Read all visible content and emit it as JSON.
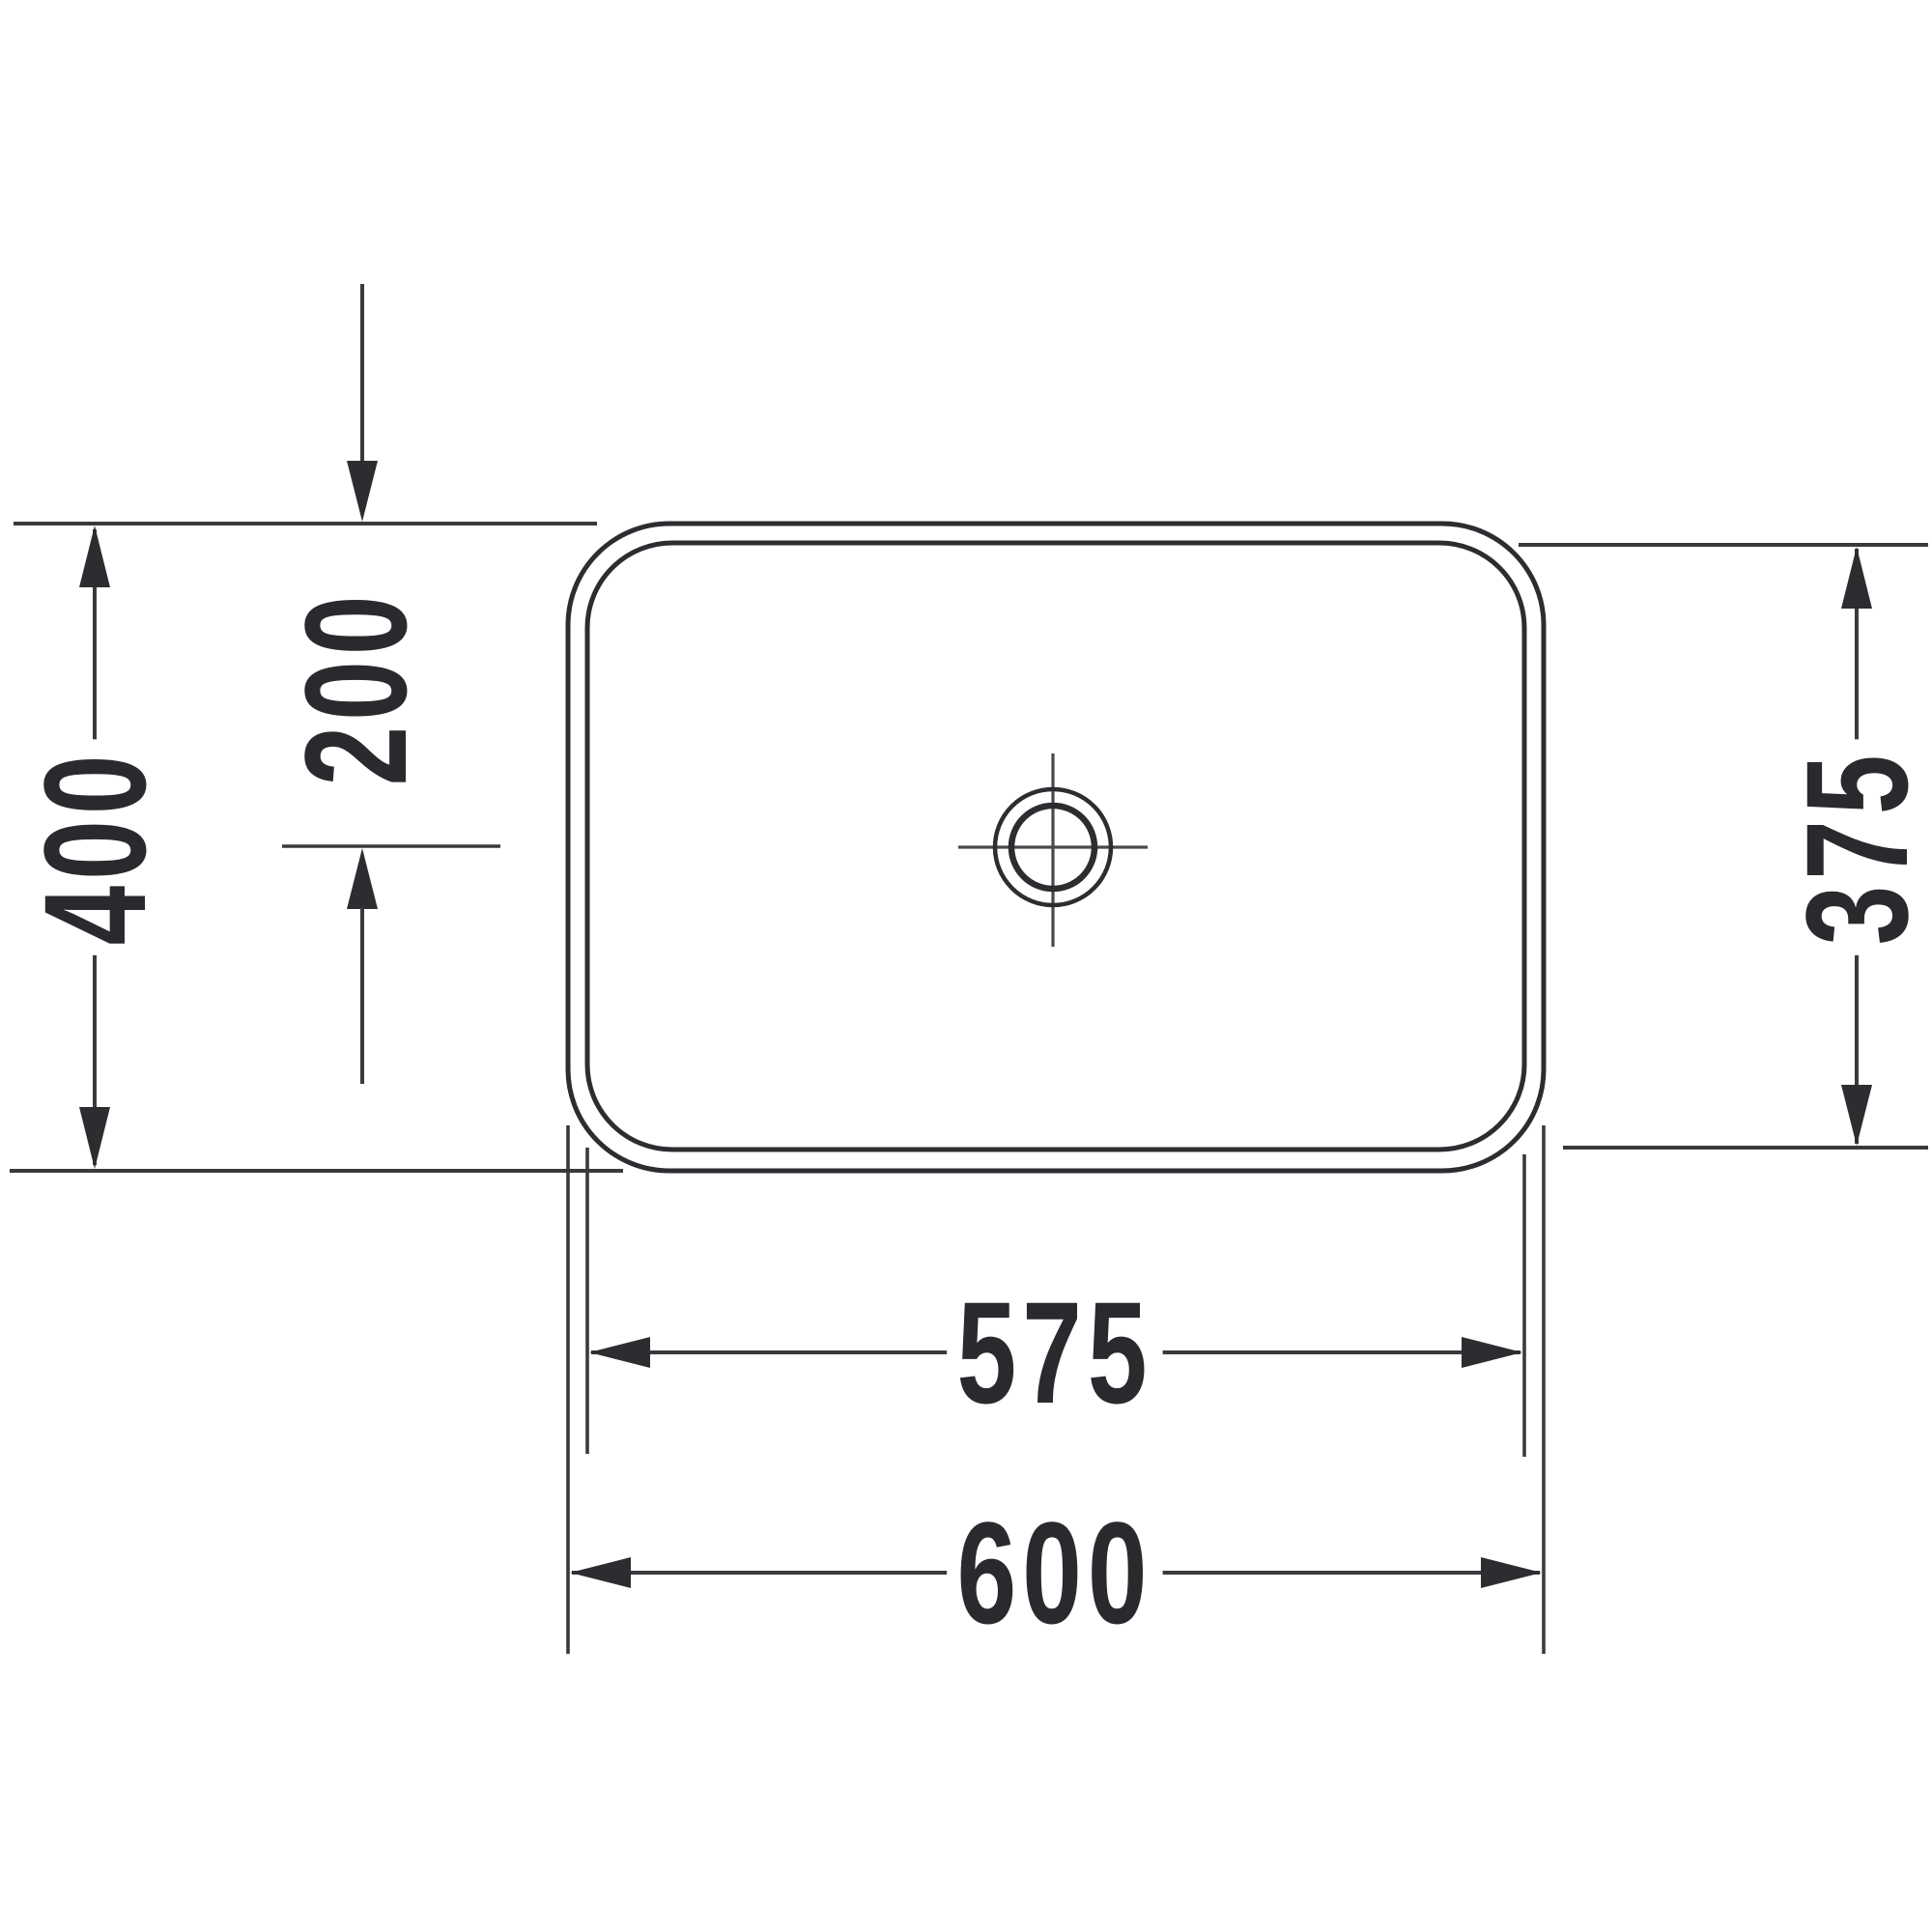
{
  "diagram": {
    "type": "technical-dimension-drawing",
    "subject": "rectangular countertop washbasin, top view (plan)",
    "units": "mm",
    "colors": {
      "line": "#3a3a3d",
      "outline": "#2d2d31",
      "arrow": "#2d2d31",
      "text": "#2a2a2e",
      "background": "#ffffff"
    },
    "dimensions": {
      "outer_depth": {
        "value": "400",
        "orientation": "vertical",
        "meaning": "overall front-to-back depth"
      },
      "drain_offset": {
        "value": "200",
        "orientation": "vertical",
        "meaning": "drain centre offset from rear edge"
      },
      "inner_depth": {
        "value": "375",
        "orientation": "vertical",
        "meaning": "inner rim front-to-back depth"
      },
      "inner_width": {
        "value": "575",
        "orientation": "horizontal",
        "meaning": "inner rim width"
      },
      "outer_width": {
        "value": "600",
        "orientation": "horizontal",
        "meaning": "overall width"
      }
    }
  }
}
